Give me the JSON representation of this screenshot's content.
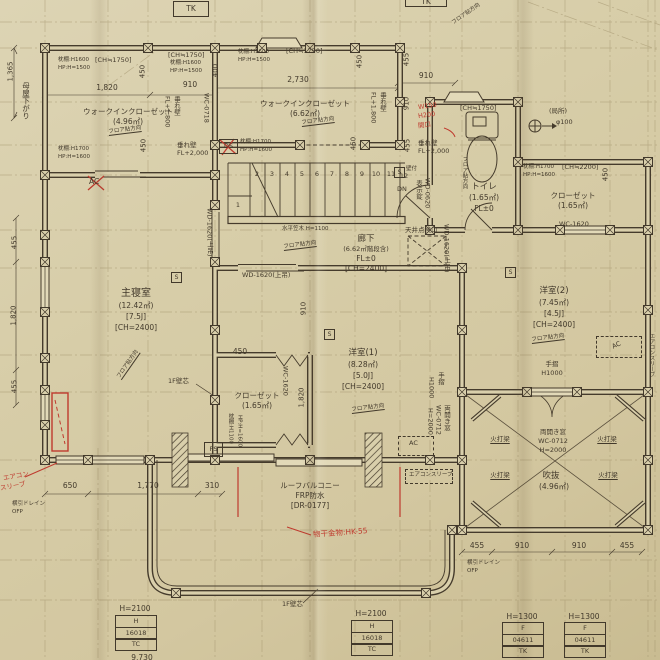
{
  "colors": {
    "paper": "#d6cca6",
    "ink": "#453b2c",
    "red": "#bf3a2e"
  },
  "rooms": {
    "wic1": {
      "name": "ウォークインクローゼット",
      "area": "(4.96㎡)"
    },
    "wic2": {
      "name": "ウォークインクローゼット",
      "area": "(6.62㎡)"
    },
    "toilet": {
      "name": "トイレ",
      "area": "(1.65㎡)",
      "fl": "FL±0"
    },
    "closet_right": {
      "name": "クローゼット",
      "area": "(1.65㎡)"
    },
    "closet_center": {
      "name": "クローゼット",
      "area": "(1.65㎡)"
    },
    "master": {
      "name": "主寝室",
      "area": "(12.42㎡)",
      "mats": "[7.5J]",
      "ch": "[CH=2400]"
    },
    "corridor": {
      "name": "廊下",
      "area": "(6.62㎡階段含)",
      "fl": "FL±0",
      "ch": "[CH=2400]"
    },
    "west1": {
      "name": "洋室(1)",
      "area": "(8.28㎡)",
      "mats": "[5.0J]",
      "ch": "[CH=2400]"
    },
    "west2": {
      "name": "洋室(2)",
      "area": "(7.45㎡)",
      "mats": "[4.5J]",
      "ch": "[CH=2400]"
    },
    "void": {
      "name": "吹抜",
      "area": "(4.96㎡)"
    },
    "balcony": {
      "line1": "ルーフバルコニー",
      "line2": "FRP防水",
      "line3": "[DR-0177]"
    }
  },
  "shelves": {
    "p1600": "枕棚:H1600",
    "hp1500": "HP:H=1500",
    "p1700": "枕棚:H1700",
    "hp1600": "HP:H=1600",
    "p1100": "枕棚:H1100",
    "ch1750": "[CH≒1750]",
    "ch2200": "[CH≒2200]"
  },
  "openings": {
    "wd1620": "WD-1620(上吊)",
    "wd0620": "WD-0620",
    "lock": "表示錠",
    "wc1620": "WC-1620",
    "wc0718": "WC-0718",
    "dbl_l1": "両開き窓",
    "dbl_l2": "WC-0712",
    "dbl_l3": "H=2000"
  },
  "features": {
    "kasagi": "水平笠木 H=1100",
    "inspection": "天井点検口",
    "handrail": "手摺",
    "handrail_h": "H1000",
    "local": "(局所)",
    "dia": "φ100",
    "brace": "火打梁",
    "floor_dir": "フロア貼方向",
    "wall_core": "1F壁芯",
    "drain": "横引ドレイン",
    "ofp": "OFP",
    "ac": "AC",
    "ac_sleeve": "エアコンスリーブ",
    "hanging_wall": "垂れ壁",
    "fl1800": "FL+1,800",
    "fl2000": "FL+2,000",
    "ds": "DS",
    "ps": "PS",
    "s_mark": "S",
    "wall_mount": "壁付",
    "moya_sagari": "母屋下がり",
    "dn": "DN"
  },
  "stairs": {
    "numbers": [
      "1",
      "2",
      "3",
      "4",
      "5",
      "6",
      "7",
      "8",
      "9",
      "10",
      "11",
      "12"
    ]
  },
  "dims": {
    "d1365": "1,365",
    "d1820": "1,820",
    "d910": "910",
    "d2730": "2,730",
    "d450": "450",
    "d400": "400",
    "d455": "455",
    "d650": "650",
    "d1770": "1,770",
    "d310": "310",
    "d9730": "9,730"
  },
  "red_notes": {
    "w150": "W150",
    "h200": "H200",
    "opening": "開口",
    "aircon1": "エアコン",
    "aircon2": "スリーブ",
    "laundry": "物干金物:HK-55"
  },
  "tables": {
    "top_cell": "TK",
    "t1": {
      "header": "H=2100",
      "rows": [
        "H",
        "16018",
        "TC"
      ]
    },
    "t2": {
      "header": "H=2100",
      "rows": [
        "H",
        "16018",
        "TC"
      ]
    },
    "t3": {
      "header": "H=1300",
      "rows": [
        "F",
        "04611",
        "TK"
      ]
    },
    "t4": {
      "header": "H=1300",
      "rows": [
        "F",
        "04611",
        "TK"
      ]
    }
  }
}
